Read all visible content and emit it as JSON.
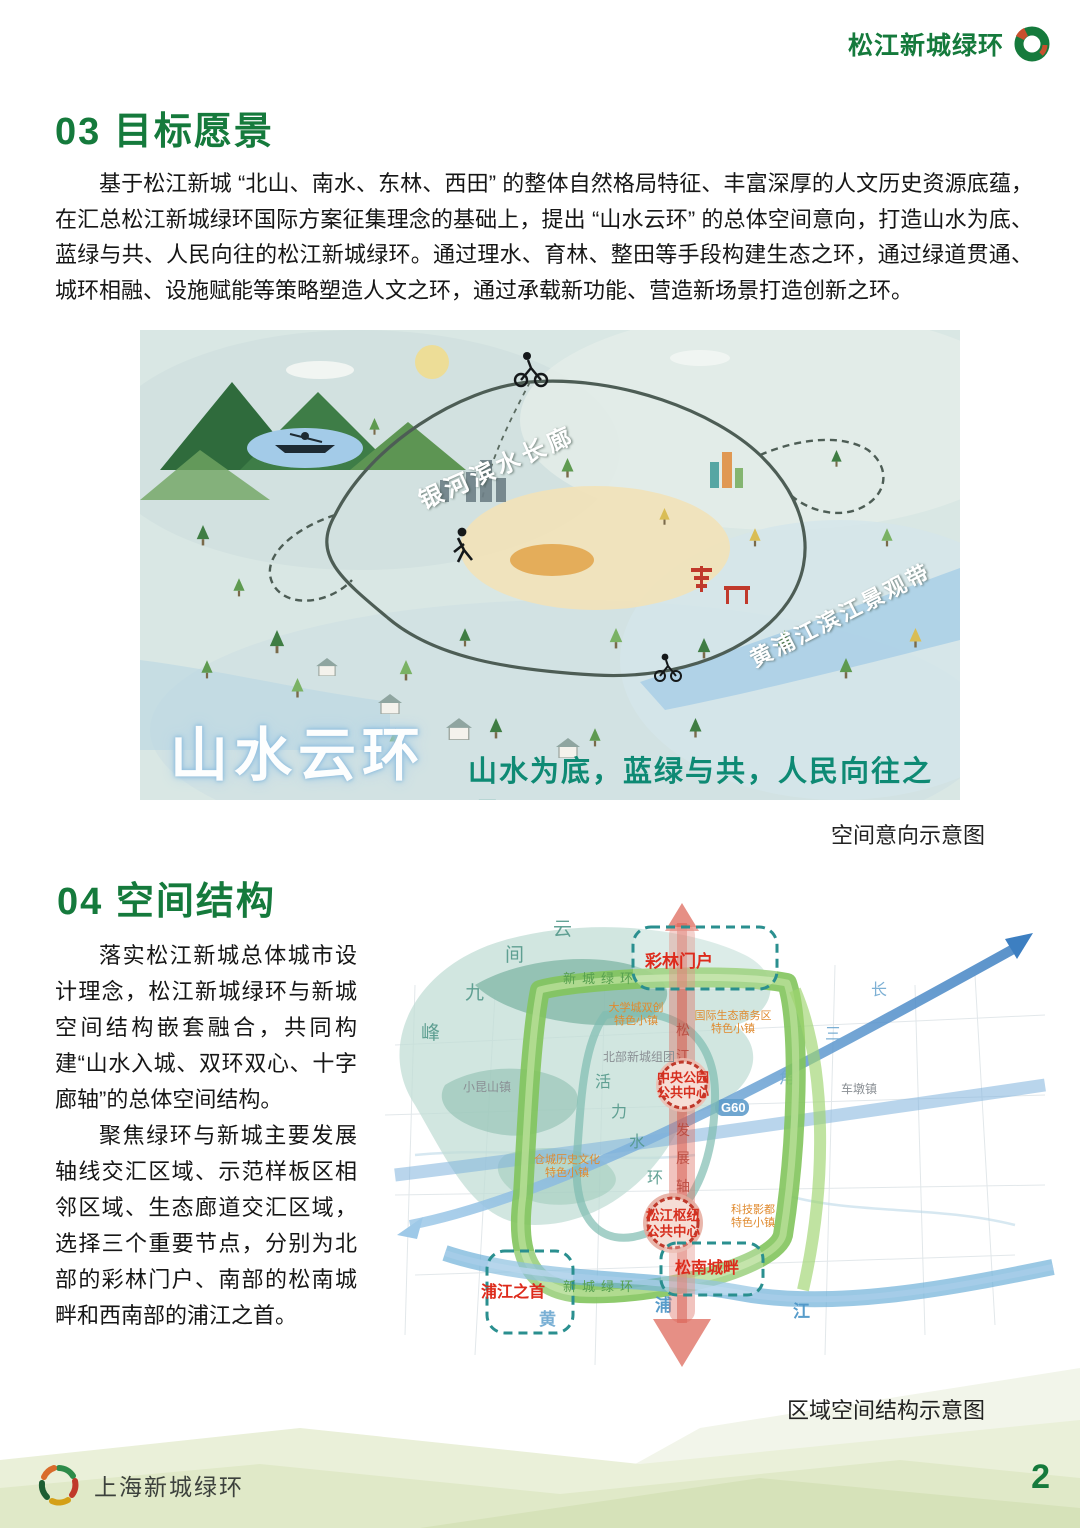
{
  "header": {
    "brand": "松江新城绿环"
  },
  "section03": {
    "title": "03 目标愿景",
    "paragraph": "基于松江新城 “北山、南水、东林、西田” 的整体自然格局特征、丰富深厚的人文历史资源底蕴，在汇总松江新城绿环国际方案征集理念的基础上，提出 “山水云环” 的总体空间意向，打造山水为底、蓝绿与共、人民向往的松江新城绿环。通过理水、育林、整田等手段构建生态之环，通过绿道贯通、城环相融、设施赋能等策略塑造人文之环，通过承载新功能、营造新场景打造创新之环。"
  },
  "illustration": {
    "corridor_label": "银河滨水长廊",
    "river_label": "黄浦江滨江景观带",
    "title": "山水云环",
    "tagline": "山水为底，蓝绿与共，人民向往之环",
    "caption": "空间意向示意图"
  },
  "section04": {
    "title": "04 空间结构",
    "paragraph1": "落实松江新城总体城市设计理念，松江新城绿环与新城空间结构嵌套融合，共同构建“山水入城、双环双心、十字廊轴”的总体空间结构。",
    "paragraph2": "聚焦绿环与新城主要发展轴线交汇区域、示范样板区相邻区域、生态廊道交汇区域，选择三个重要节点，分别为北部的彩林门户、南部的松南城畔和西南部的浦江之首。",
    "caption": "区域空间结构示意图"
  },
  "map": {
    "node_north": "彩林门户",
    "node_south": "松南城畔",
    "node_southwest": "浦江之首",
    "center1_line1": "中央公园",
    "center1_line2": "公共中心",
    "center2_line1": "松江枢纽",
    "center2_line2": "公共中心",
    "ring_label_top": "新城绿环",
    "ring_label_bottom": "新城绿环",
    "town1_line1": "大学城双创",
    "town1_line2": "特色小镇",
    "town2_line1": "国际生态商务区",
    "town2_line2": "特色小镇",
    "town3_line1": "仓城历史文化",
    "town3_line2": "特色小镇",
    "town4_line1": "科技影都",
    "town4_line2": "特色小镇",
    "district_north": "北部新城组团",
    "town_xiaokunshan": "小昆山镇",
    "town_chedun": "车墩镇",
    "g60": "G60",
    "mountain_chars": [
      "云",
      "间",
      "九",
      "峰"
    ],
    "water_ring_chars": [
      "活",
      "力",
      "水",
      "环"
    ],
    "axis_chars": [
      "松",
      "江",
      "发",
      "展",
      "轴"
    ],
    "delta_chars": [
      "长",
      "三",
      "角"
    ],
    "river_chars": [
      "黄",
      "浦",
      "江"
    ]
  },
  "footer": {
    "brand": "上海新城绿环",
    "page_number": "2"
  },
  "colors": {
    "heading_green": "#157a3c",
    "tagline_teal": "#0e8a74",
    "map_red": "#dd2b1c"
  }
}
